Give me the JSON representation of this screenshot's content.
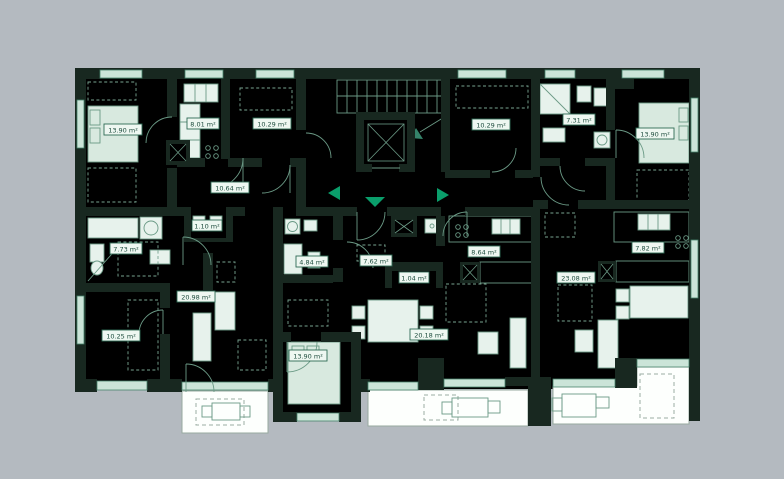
{
  "plan": {
    "type": "apartment-floor-plan",
    "colors": {
      "background": "#b4bac0",
      "floor": "#dfece5",
      "wall": "#182820",
      "window": "#cbe4d8",
      "balcony": "#fdfffd",
      "accent_green": "#0a9e6b",
      "label_text": "#1d4c3d"
    },
    "rooms": [
      {
        "name": "bedroom-left",
        "area": "13.90 m²"
      },
      {
        "name": "kitchen-left",
        "area": "8.01 m²"
      },
      {
        "name": "room-top-left",
        "area": "10.29 m²"
      },
      {
        "name": "hall-left",
        "area": "10.64 m²"
      },
      {
        "name": "wc-left",
        "area": "1.10 m²"
      },
      {
        "name": "room-right-of-core",
        "area": "10.29 m²"
      },
      {
        "name": "bathroom-top-right",
        "area": "7.31 m²"
      },
      {
        "name": "bedroom-top-right",
        "area": "13.90 m²"
      },
      {
        "name": "bathroom-left",
        "area": "7.73 m²"
      },
      {
        "name": "living-room-left",
        "area": "20.98 m²"
      },
      {
        "name": "room-bottom-left",
        "area": "10.25 m²"
      },
      {
        "name": "bathroom-center",
        "area": "4.84 m²"
      },
      {
        "name": "hall-center",
        "area": "7.62 m²"
      },
      {
        "name": "closet-center",
        "area": "1.04 m²"
      },
      {
        "name": "kitchen-center",
        "area": "8.64 m²"
      },
      {
        "name": "living-room-center",
        "area": "20.18 m²"
      },
      {
        "name": "bedroom-center",
        "area": "13.90 m²"
      },
      {
        "name": "living-room-right",
        "area": "23.08 m²"
      },
      {
        "name": "kitchen-right",
        "area": "7.82 m²"
      }
    ],
    "entrance_markers": [
      {
        "direction": "left"
      },
      {
        "direction": "down"
      },
      {
        "direction": "right"
      }
    ]
  }
}
